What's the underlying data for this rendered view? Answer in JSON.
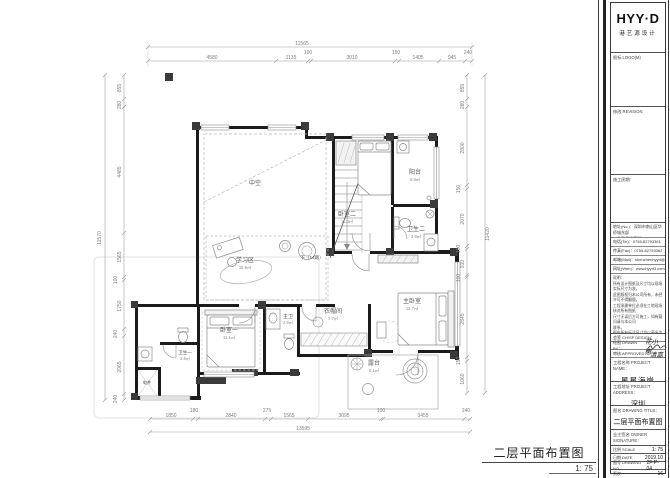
{
  "brand": {
    "logo": "HYY·D",
    "logo_sub": "港艺源设计"
  },
  "titleblock": {
    "logo_section": "图标 LOGO(M)",
    "revision_section": "修改 REVISION",
    "stage_section": "施工图期:",
    "contact": {
      "addr1": "地址(No.)：深圳市南山区华侨城东部",
      "addr2": "工业区侨香官邸H3-107A",
      "tel": "电话(Tel)：0755-82793361",
      "fax": "传真(Fax)：0755-82793362",
      "mail": "邮箱(Mail)：shenzhenhyyd@163.com",
      "web": "网址(Web)：www.hyyd3.com"
    },
    "notes": {
      "label": "说明：",
      "l1": "所有设计图纸及尺寸均以现场实际尺寸为准，",
      "l2": "此图版权归本公司所有，未经许可不得翻版。",
      "l3": "工程承建单位必须在工地现场核对所有图纸",
      "l4": "尺寸无误后方可施工，如有疑问请与本公司",
      "l5": "联系。",
      "l6": "图中所有标注尺寸均以毫米为单位，标高以",
      "l7": "米为单位。"
    },
    "sign": {
      "chief_label": "会签 CH/SP DESIGN：",
      "drawn_label": "绘图 DRAWN BY：",
      "drawn_value": "花小惠",
      "approved_label": "审核 APPROVED：",
      "approved_value": "清嘉"
    },
    "project": {
      "name_label": "工程名称 PROJECT NAME：",
      "name": "星星海岸",
      "addr_label": "工程地址 PROJECT ADDRESS：",
      "addr": "深圳",
      "title_label": "图名 DRAWING TITLE：",
      "title": "二层平面布置图",
      "owner_label": "业主签名 OWNER SIGNATURE："
    },
    "meta": {
      "scale_label": "比例 SCALE",
      "scale": "1: 75",
      "date_label": "日期 DATE",
      "date": "2019.10",
      "no_label": "图号 DRAWING NO.",
      "no": "2F-P-04",
      "page_label": "页次",
      "page": "16"
    }
  },
  "footer": {
    "title": "二层平面布置图",
    "scale": "1: 75"
  },
  "rooms": [
    {
      "name": "中空",
      "area": ""
    },
    {
      "name": "阳台",
      "area": "5.9㎡"
    },
    {
      "name": "卧室二",
      "area": "11.5㎡"
    },
    {
      "name": "卫生二",
      "area": "3.9㎡"
    },
    {
      "name": "学习区",
      "area": "15.9㎡"
    },
    {
      "name": "卧室一",
      "area": "11.1㎡"
    },
    {
      "name": "主卫",
      "area": "2.5㎡"
    },
    {
      "name": "衣帽间",
      "area": "7.7㎡"
    },
    {
      "name": "主卧室",
      "area": "13.7㎡"
    },
    {
      "name": "露台",
      "area": "6.1㎡"
    },
    {
      "name": "电井",
      "area": ""
    },
    {
      "name": "卫生一",
      "area": "2.8㎡"
    }
  ],
  "stair_note": "下（14踏）",
  "dims": {
    "top": {
      "total": "11565",
      "segments": [
        "4580",
        "1135",
        "100",
        "3010",
        "150",
        "1405",
        "945",
        "240"
      ]
    },
    "bottom": {
      "total": "13595",
      "segments": [
        "1850",
        "180",
        "2840",
        "275",
        "1565",
        "3095",
        "100",
        "3455",
        "240"
      ]
    },
    "left": {
      "total": "11570",
      "segments": [
        "855",
        "280",
        "4485",
        "1565",
        "100",
        "1750",
        "240",
        "2065",
        "240"
      ]
    },
    "right": {
      "total": "11420",
      "segments": [
        "855",
        "280",
        "2800",
        "150",
        "2070",
        "100",
        "910",
        "100",
        "2845",
        "150",
        "1060"
      ]
    }
  }
}
